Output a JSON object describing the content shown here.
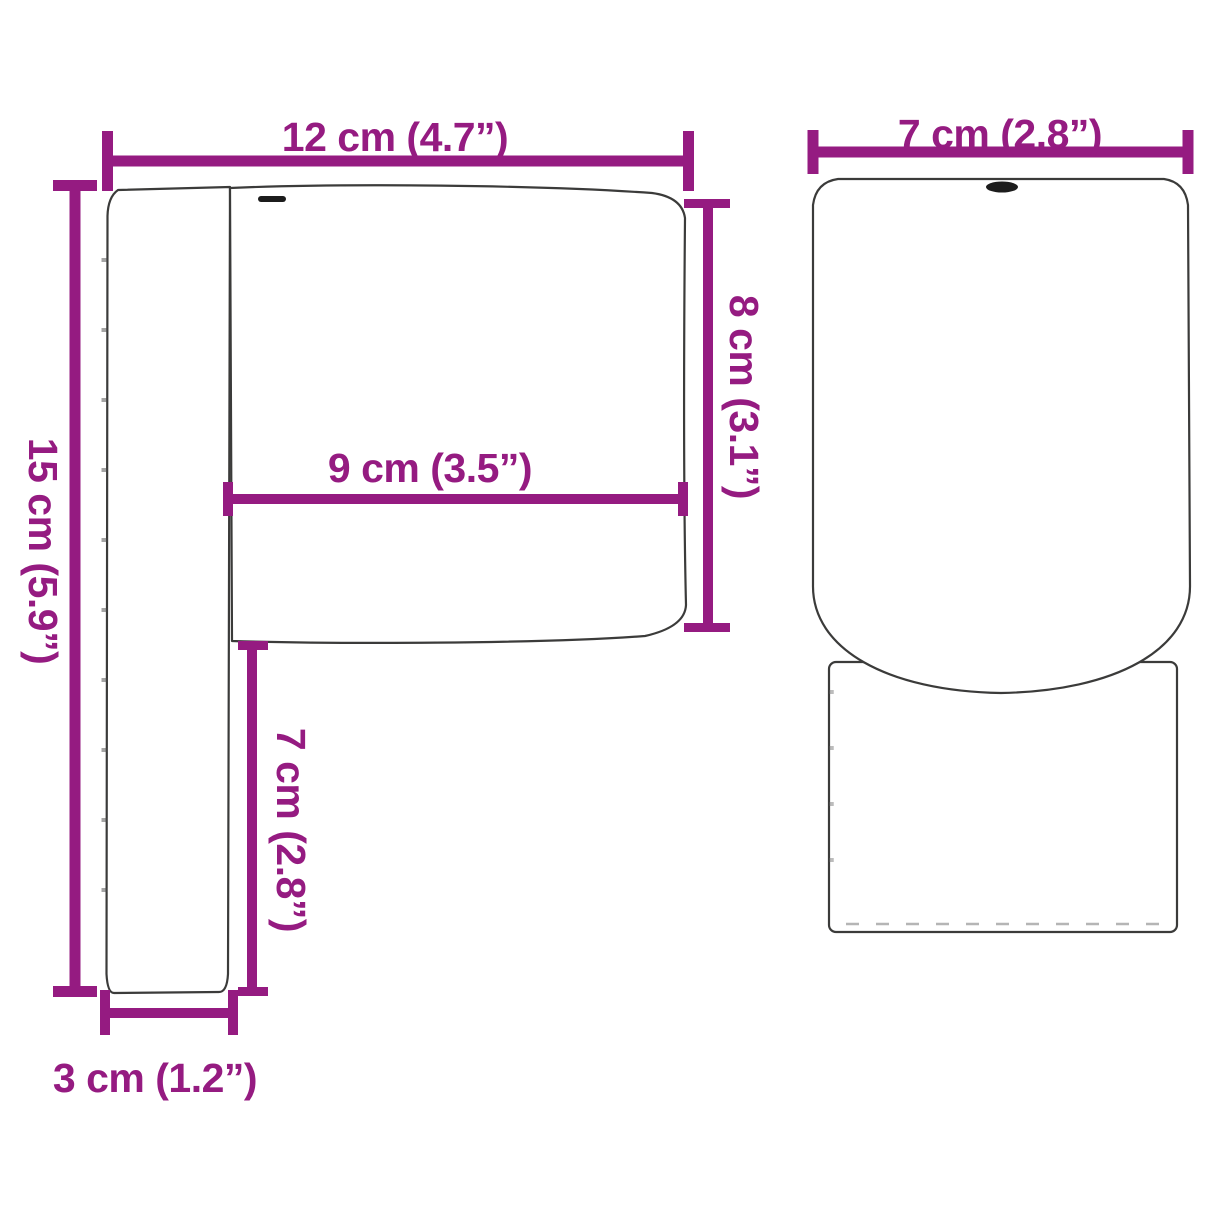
{
  "diagram": {
    "type": "product-dimension-diagram",
    "views": [
      "side-profile",
      "front"
    ],
    "colors": {
      "accent": "#951b81",
      "outline": "#3b3b3a",
      "buttonhole": "#1c1c1c",
      "background": "#ffffff"
    }
  },
  "side_view": {
    "dim_total_width": "12 cm (4.7”)",
    "dim_total_height": "15 cm (5.9”)",
    "dim_cushion_depth": "9 cm (3.5”)",
    "dim_cushion_height": "8 cm (3.1”)",
    "dim_lower_height": "7 cm (2.8”)",
    "dim_base_depth": "3 cm (1.2”)"
  },
  "front_view": {
    "dim_width": "7 cm (2.8”)"
  },
  "measurements": [
    {
      "name": "total width (side view, top)",
      "cm": 12,
      "inches": 4.7
    },
    {
      "name": "total height (side view, left)",
      "cm": 15,
      "inches": 5.9
    },
    {
      "name": "cushion depth (side view, middle)",
      "cm": 9,
      "inches": 3.5
    },
    {
      "name": "cushion height (side view, right)",
      "cm": 8,
      "inches": 3.1
    },
    {
      "name": "lower section height (side view)",
      "cm": 7,
      "inches": 2.8
    },
    {
      "name": "base depth (side view, bottom)",
      "cm": 3,
      "inches": 1.2
    },
    {
      "name": "width (front view)",
      "cm": 7,
      "inches": 2.8
    }
  ]
}
